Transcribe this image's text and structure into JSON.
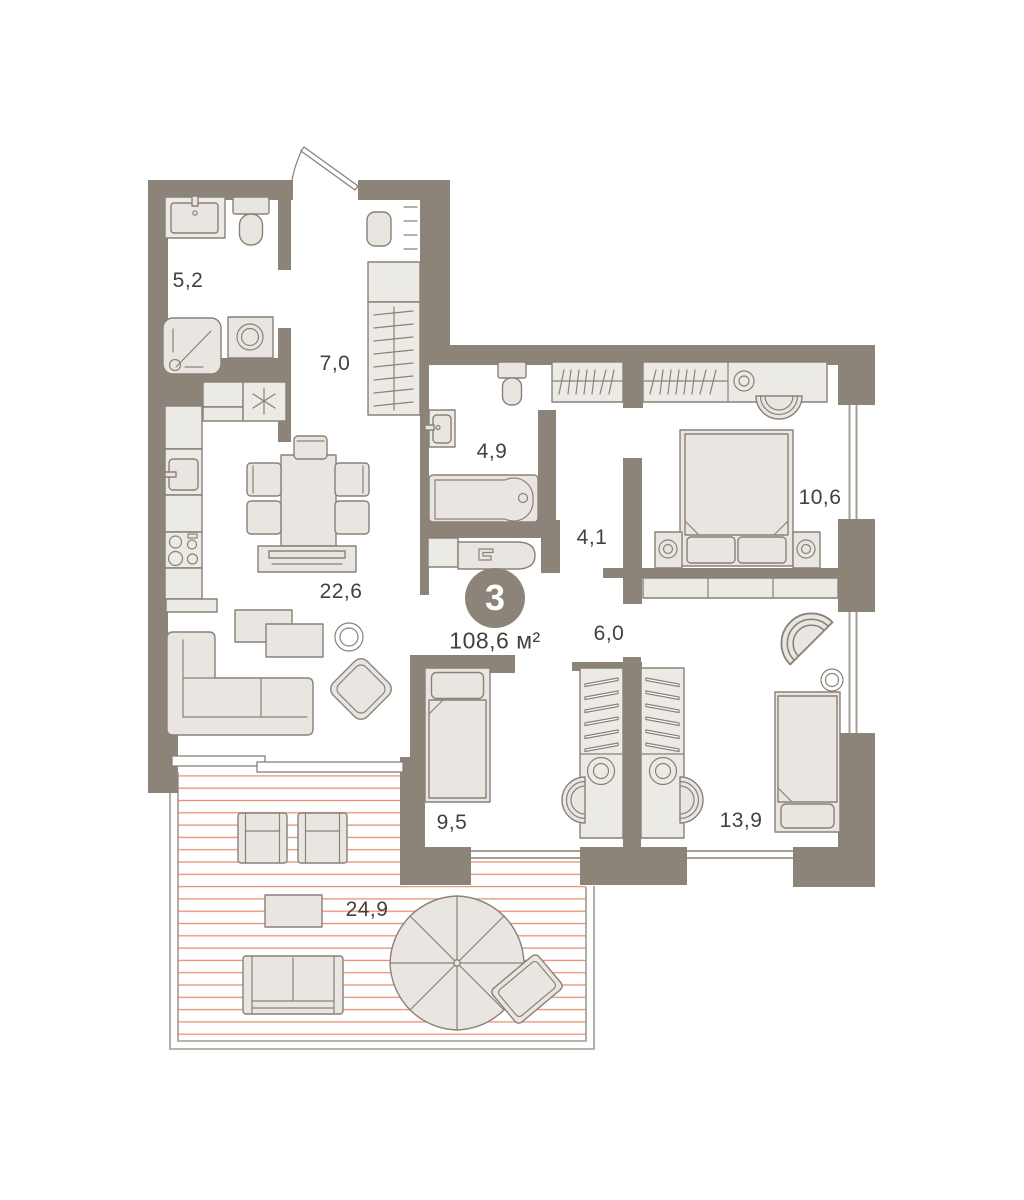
{
  "plan": {
    "type_badge": "3",
    "total_area": "108,6 м²",
    "rooms": [
      {
        "name": "bathroom-small",
        "area": "5,2"
      },
      {
        "name": "hallway",
        "area": "7,0"
      },
      {
        "name": "bathroom",
        "area": "4,9"
      },
      {
        "name": "corridor",
        "area": "4,1"
      },
      {
        "name": "bedroom-1",
        "area": "10,6"
      },
      {
        "name": "kitchen-living-room",
        "area": "22,6"
      },
      {
        "name": "corridor-2",
        "area": "6,0"
      },
      {
        "name": "bedroom-2",
        "area": "9,5"
      },
      {
        "name": "bedroom-3",
        "area": "13,9"
      },
      {
        "name": "terrace",
        "area": "24,9"
      }
    ],
    "colors": {
      "wall": "#8C8379",
      "furniture_fill": "#E9E6E1",
      "furniture_stroke": "#8A8178",
      "deck_line": "#E69070",
      "text": "#44413D",
      "badge_background": "#8C8379",
      "badge_text": "#FFFFFF"
    }
  }
}
